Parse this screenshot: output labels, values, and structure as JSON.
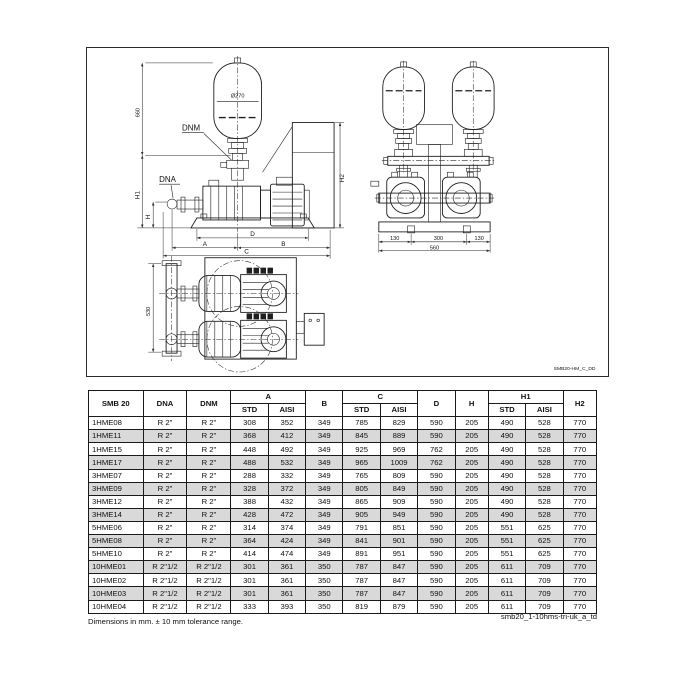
{
  "drawing": {
    "id_label": "SMB20-HM_C_DD",
    "labels": {
      "dnm": "DNM",
      "dna": "DNA",
      "tank_diameter": "Ø270",
      "height_660": "660",
      "h1": "H1",
      "h": "H",
      "h2": "H2",
      "dim_a": "A",
      "dim_b": "B",
      "dim_c": "C",
      "dim_d": "D",
      "front": [
        "130",
        "300",
        "130"
      ],
      "front_total": "560",
      "plan_depth": "530"
    }
  },
  "table": {
    "header": {
      "model": "SMB 20",
      "dna": "DNA",
      "dnm": "DNM",
      "a": "A",
      "b": "B",
      "c": "C",
      "d": "D",
      "h": "H",
      "h1": "H1",
      "h2": "H2",
      "std": "STD",
      "aisi": "AISI"
    },
    "rows": [
      [
        "1HME08",
        "R 2\"",
        "R 2\"",
        "308",
        "352",
        "349",
        "785",
        "829",
        "590",
        "205",
        "490",
        "528",
        "770"
      ],
      [
        "1HME11",
        "R 2\"",
        "R 2\"",
        "368",
        "412",
        "349",
        "845",
        "889",
        "590",
        "205",
        "490",
        "528",
        "770"
      ],
      [
        "1HME15",
        "R 2\"",
        "R 2\"",
        "448",
        "492",
        "349",
        "925",
        "969",
        "762",
        "205",
        "490",
        "528",
        "770"
      ],
      [
        "1HME17",
        "R 2\"",
        "R 2\"",
        "488",
        "532",
        "349",
        "965",
        "1009",
        "762",
        "205",
        "490",
        "528",
        "770"
      ],
      [
        "3HME07",
        "R 2\"",
        "R 2\"",
        "288",
        "332",
        "349",
        "765",
        "809",
        "590",
        "205",
        "490",
        "528",
        "770"
      ],
      [
        "3HME09",
        "R 2\"",
        "R 2\"",
        "328",
        "372",
        "349",
        "805",
        "849",
        "590",
        "205",
        "490",
        "528",
        "770"
      ],
      [
        "3HME12",
        "R 2\"",
        "R 2\"",
        "388",
        "432",
        "349",
        "865",
        "909",
        "590",
        "205",
        "490",
        "528",
        "770"
      ],
      [
        "3HME14",
        "R 2\"",
        "R 2\"",
        "428",
        "472",
        "349",
        "905",
        "949",
        "590",
        "205",
        "490",
        "528",
        "770"
      ],
      [
        "5HME06",
        "R 2\"",
        "R 2\"",
        "314",
        "374",
        "349",
        "791",
        "851",
        "590",
        "205",
        "551",
        "625",
        "770"
      ],
      [
        "5HME08",
        "R 2\"",
        "R 2\"",
        "364",
        "424",
        "349",
        "841",
        "901",
        "590",
        "205",
        "551",
        "625",
        "770"
      ],
      [
        "5HME10",
        "R 2\"",
        "R 2\"",
        "414",
        "474",
        "349",
        "891",
        "951",
        "590",
        "205",
        "551",
        "625",
        "770"
      ],
      [
        "10HME01",
        "R 2\"1/2",
        "R 2\"1/2",
        "301",
        "361",
        "350",
        "787",
        "847",
        "590",
        "205",
        "611",
        "709",
        "770"
      ],
      [
        "10HME02",
        "R 2\"1/2",
        "R 2\"1/2",
        "301",
        "361",
        "350",
        "787",
        "847",
        "590",
        "205",
        "611",
        "709",
        "770"
      ],
      [
        "10HME03",
        "R 2\"1/2",
        "R 2\"1/2",
        "301",
        "361",
        "350",
        "787",
        "847",
        "590",
        "205",
        "611",
        "709",
        "770"
      ],
      [
        "10HME04",
        "R 2\"1/2",
        "R 2\"1/2",
        "333",
        "393",
        "350",
        "819",
        "879",
        "590",
        "205",
        "611",
        "709",
        "770"
      ]
    ]
  },
  "footer": {
    "note": "Dimensions in mm. ± 10 mm tolerance range.",
    "doc_ref": "smb20_1-10hms-tri-uk_a_td"
  }
}
